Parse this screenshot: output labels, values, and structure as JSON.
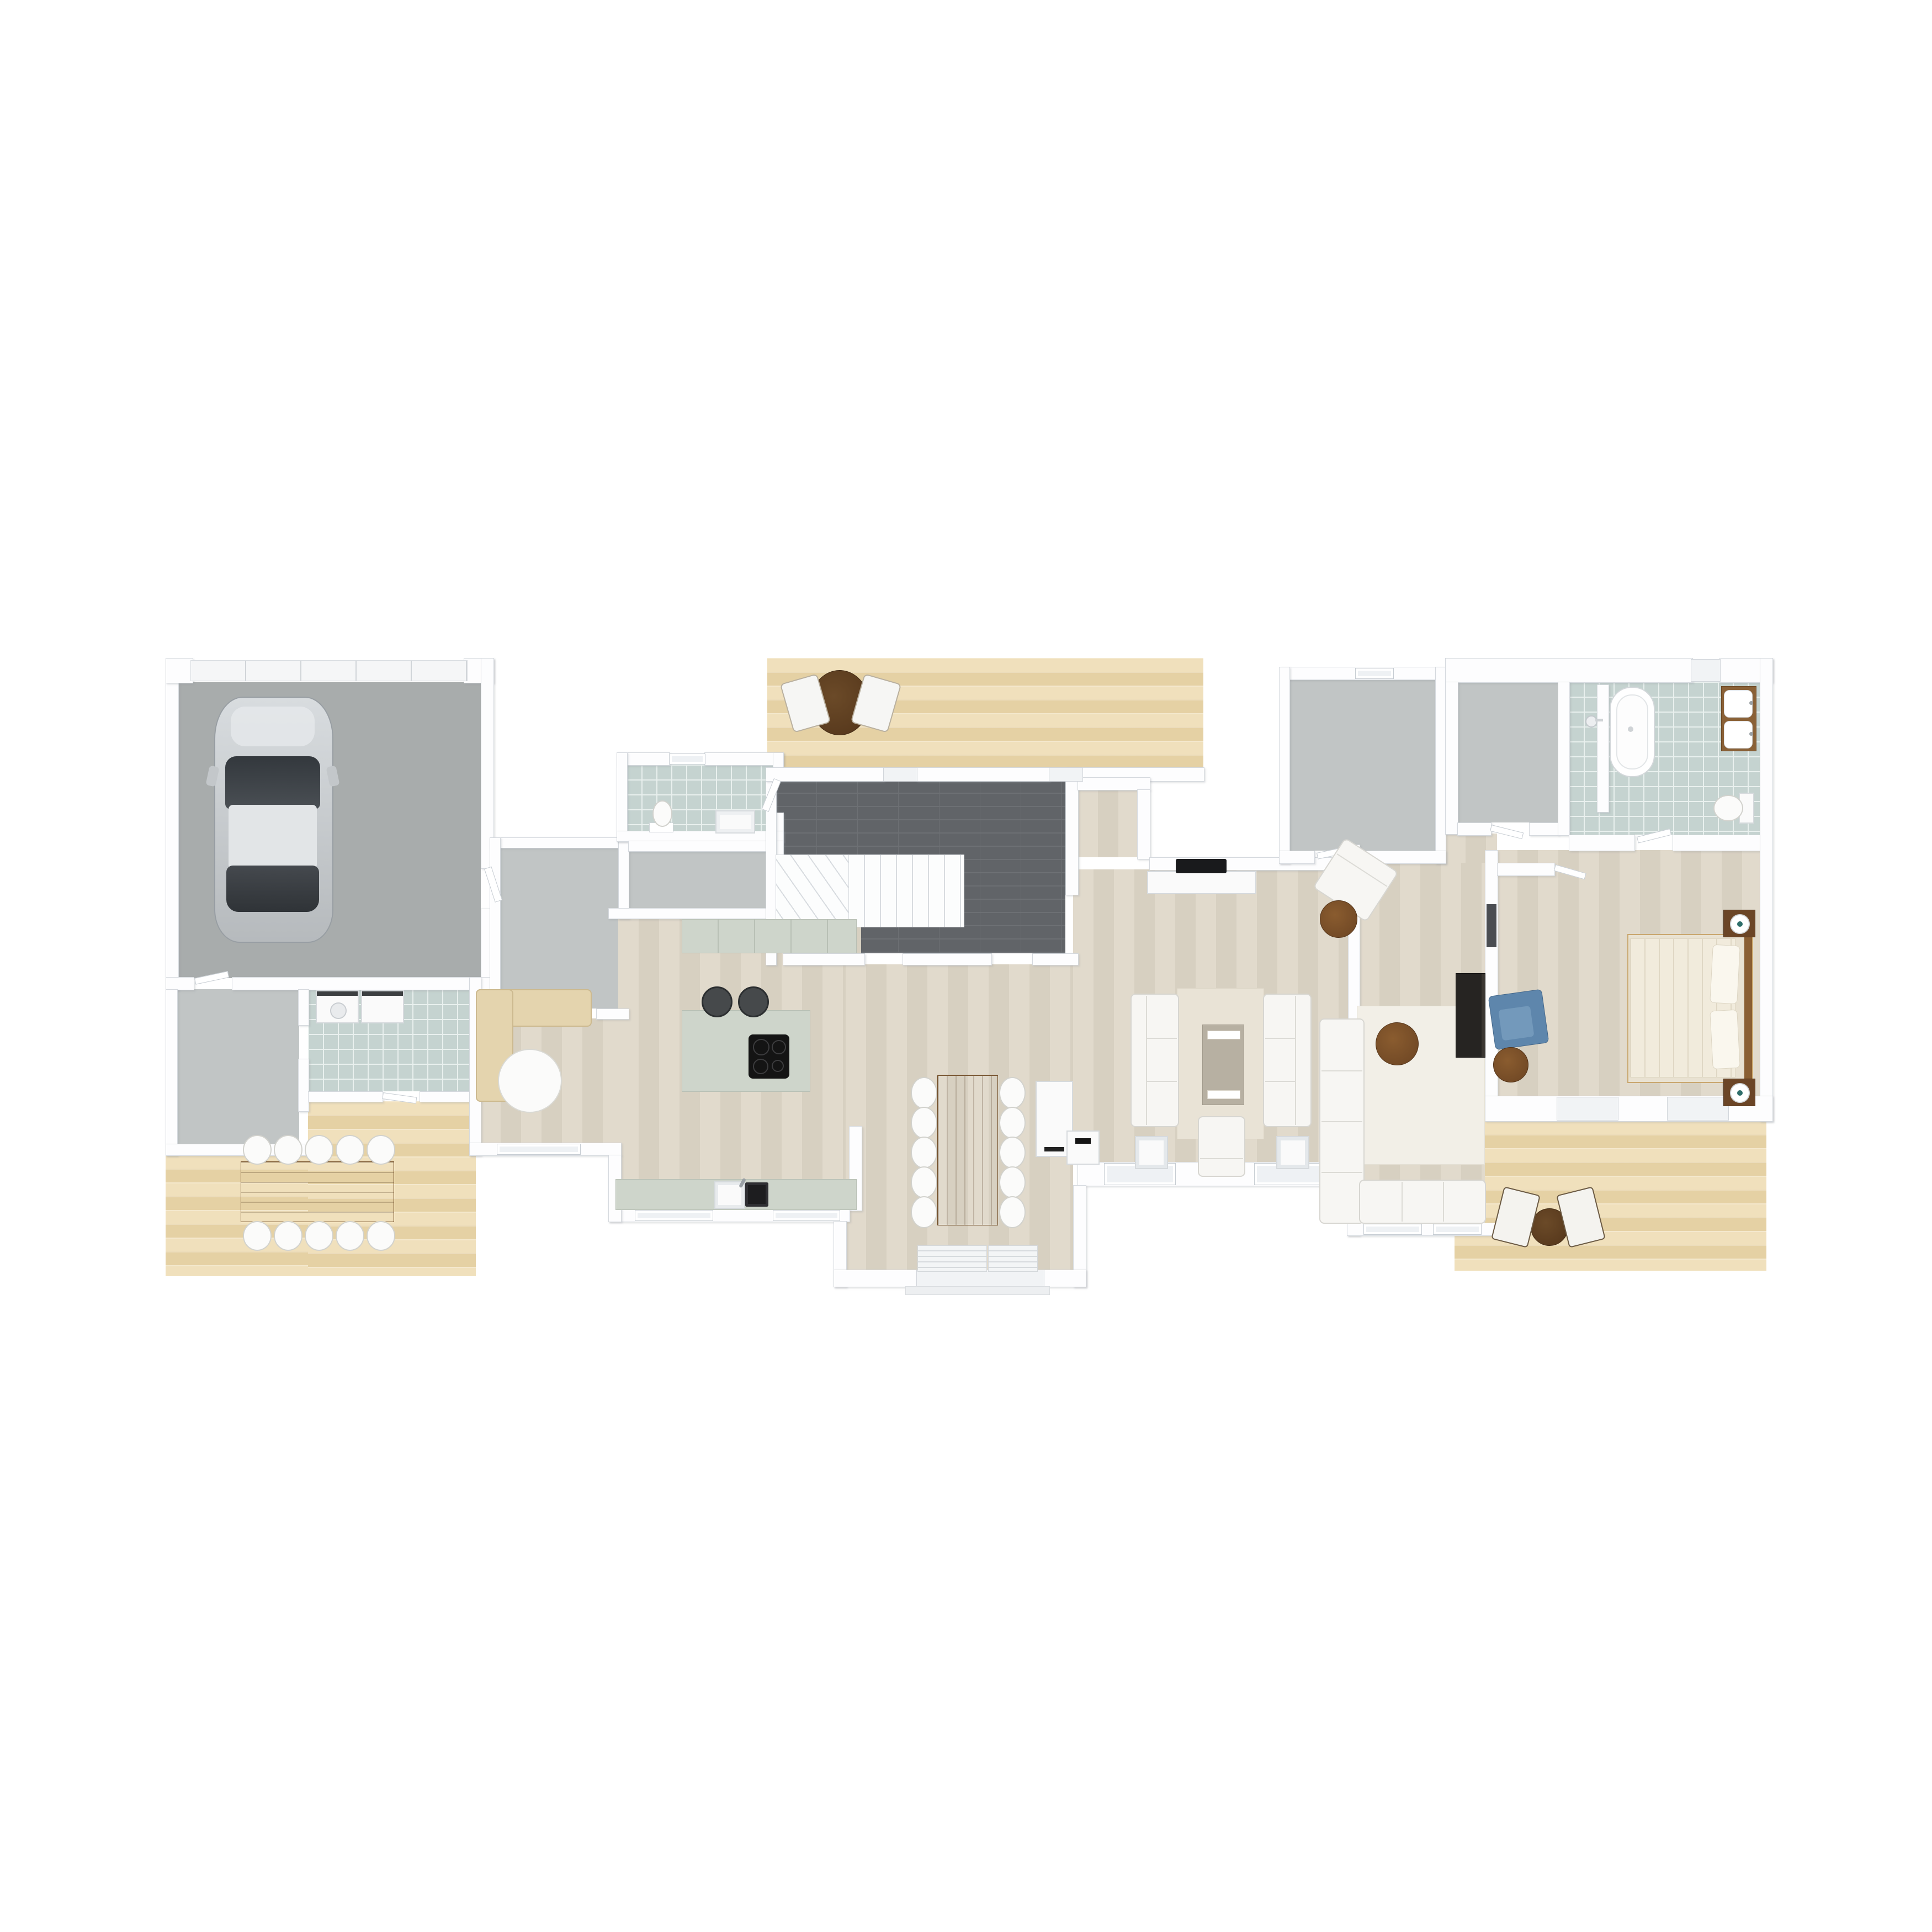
{
  "app": {
    "type": "3d-floor-plan-render",
    "view": "top-down-orthographic",
    "level": "ground-floor",
    "text_labels": "none"
  },
  "palette": {
    "background": "#ffffff",
    "wall": "#fdfdfe",
    "wall_edge": "#d5d9de",
    "concrete_floor": "#a8acac",
    "gray_floor": "#c1c5c5",
    "tile_floor": "#c5d3d0",
    "tile_grout": "#e9f0ee",
    "entry_dark_tile": "#616468",
    "interior_wood": "#ddd6c8",
    "deck_wood": "#eedcb2",
    "counter_sage": "#ced5cb",
    "table_wood": "#a0703d",
    "accent_blue_chair": "#5e86ac",
    "dark_cabinet": "#262422",
    "bed_linen": "#f0ead9"
  },
  "rooms": {
    "garage": {
      "name": "Garage",
      "floor": "concrete",
      "contents": [
        "car",
        "sectional garage door"
      ]
    },
    "mudroom": {
      "name": "Mudroom",
      "floor": "gray",
      "contents": []
    },
    "laundry": {
      "name": "Laundry room",
      "floor": "tile",
      "contents": [
        "washer",
        "dryer"
      ]
    },
    "hall_west": {
      "name": "West hall",
      "floor": "gray",
      "contents": []
    },
    "wc": {
      "name": "WC",
      "floor": "tile",
      "contents": [
        "toilet",
        "sink",
        "window"
      ]
    },
    "pantry": {
      "name": "Pantry / storage",
      "floor": "gray",
      "contents": []
    },
    "entry_hall": {
      "name": "Entry hall",
      "floor": "dark-tile",
      "contents": [
        "winder staircase"
      ]
    },
    "kitchen": {
      "name": "Kitchen",
      "floor": "wood",
      "contents": [
        "wall counter",
        "island with cooktop",
        "2 bar stools",
        "sink counter"
      ]
    },
    "nook": {
      "name": "Sitting nook",
      "floor": "wood",
      "contents": [
        "beige corner sofa",
        "round white table"
      ]
    },
    "dining": {
      "name": "Dining area",
      "floor": "wood",
      "contents": [
        "plank dining table",
        "10 white chairs",
        "white cabinet"
      ]
    },
    "living": {
      "name": "Living room",
      "floor": "wood",
      "contents": [
        "2 facing sofas",
        "coffee table with trays",
        "rug",
        "TV bench with TV",
        "2 glass side tables",
        "armchair",
        "floor lamp"
      ]
    },
    "alcove": {
      "name": "TV alcove",
      "floor": "wood",
      "contents": []
    },
    "storage_room": {
      "name": "Storage room",
      "floor": "gray",
      "contents": [
        "window"
      ]
    },
    "family_room": {
      "name": "Family room",
      "floor": "wood",
      "contents": [
        "white corner sectional",
        "round wood coffee table",
        "white rug",
        "rotated armchair",
        "round side table",
        "dark media cabinet"
      ]
    },
    "hall_east": {
      "name": "East hallway",
      "floor": "wood",
      "contents": []
    },
    "closet": {
      "name": "Walk-in closet",
      "floor": "gray",
      "contents": []
    },
    "bathroom": {
      "name": "Master bathroom",
      "floor": "tile",
      "contents": [
        "freestanding tub",
        "walk-in shower",
        "double vanity",
        "toilet"
      ]
    },
    "bedroom": {
      "name": "Master bedroom",
      "floor": "wood",
      "contents": [
        "double bed",
        "2 nightstands with lamps",
        "blue armchair",
        "round side table",
        "wardrobe"
      ]
    },
    "deck_sw": {
      "name": "South-west deck",
      "floor": "deck",
      "contents": [
        "outdoor dining table",
        "10 white chairs"
      ]
    },
    "deck_north": {
      "name": "North deck",
      "floor": "deck",
      "contents": [
        "bistro table",
        "2 lounge chairs"
      ]
    },
    "deck_se": {
      "name": "South-east deck",
      "floor": "deck",
      "contents": [
        "bistro table",
        "2 folding chairs"
      ]
    },
    "porch": {
      "name": "Entrance porch",
      "floor": "white",
      "contents": [
        "door grates"
      ]
    }
  },
  "furniture_counts": {
    "indoor_dining_chairs": 10,
    "outdoor_dining_chairs": 10,
    "bar_stools": 2,
    "living_room_sofas": 2,
    "armchairs": 4,
    "beds": 1,
    "cars": 1,
    "bathtubs": 1,
    "toilets": 2,
    "sinks": 4
  }
}
